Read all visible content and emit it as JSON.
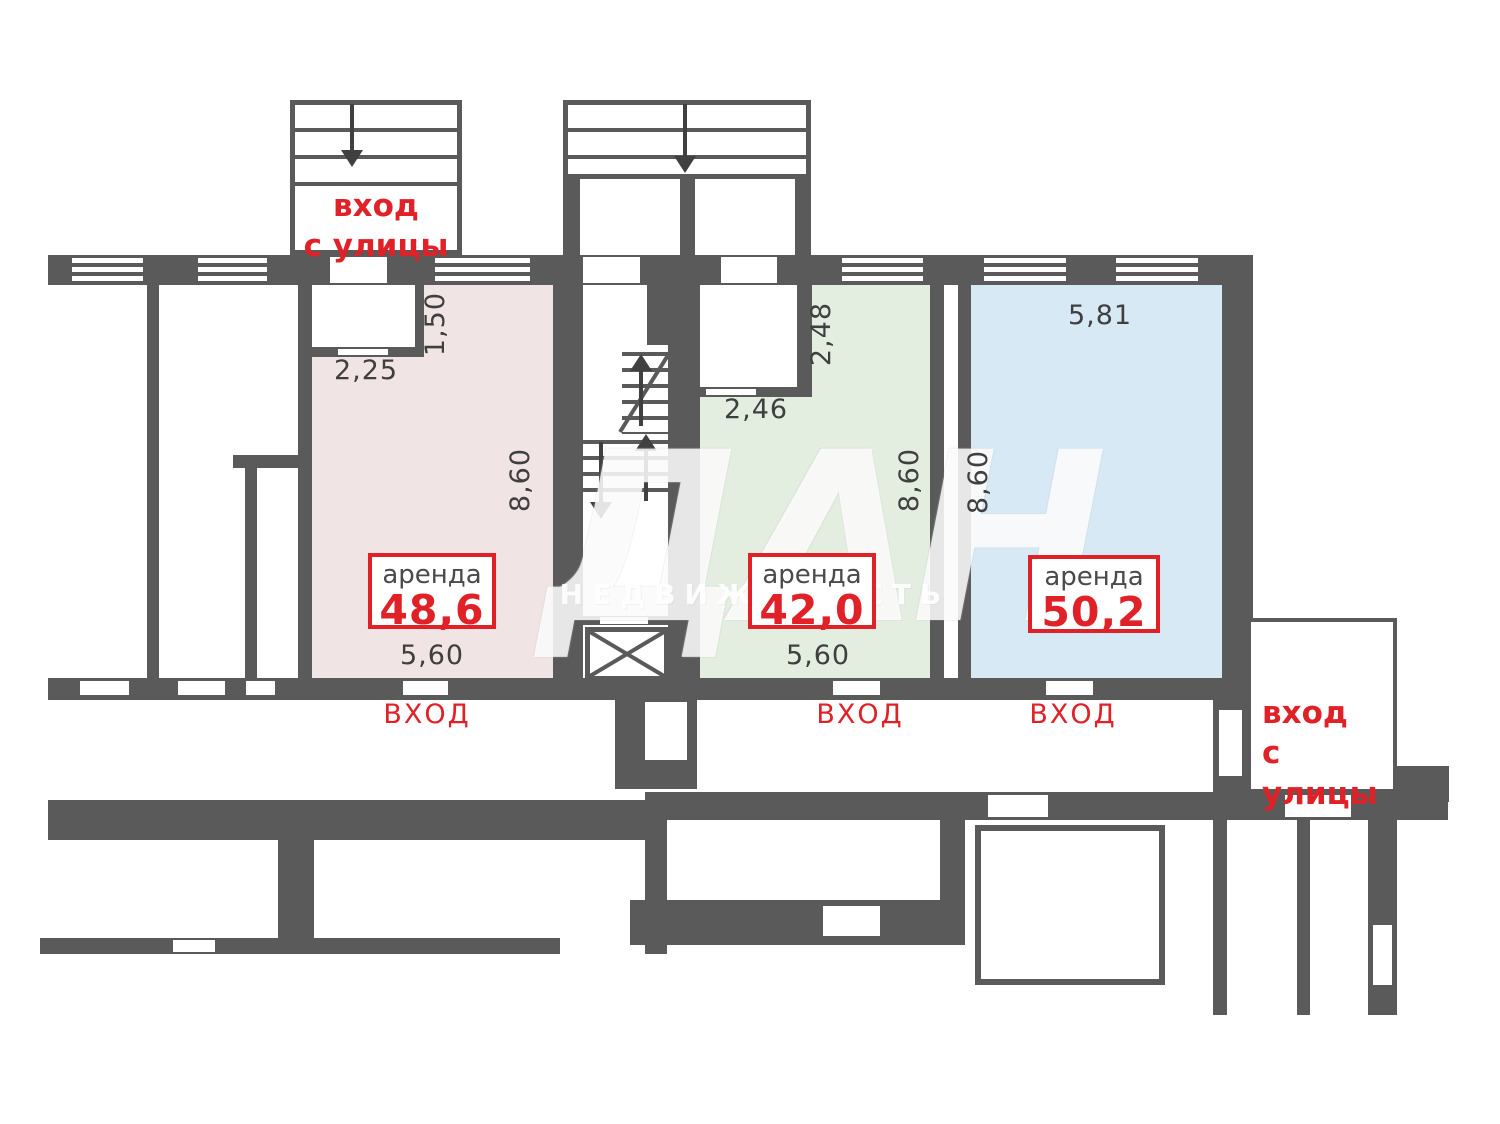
{
  "colors": {
    "wall": "#5a5a5a",
    "accent_red": "#e02128",
    "unit_pink": "#f1e4e4",
    "unit_green": "#e3eee1",
    "unit_blue": "#d8e9f6",
    "dim_text": "#3f3f3f"
  },
  "watermark": {
    "logo": "ДАН",
    "subtitle": "НЕДВИЖИМОСТЬ"
  },
  "entrances": {
    "street_top": {
      "line1": "вход",
      "line2": "с улицы"
    },
    "street_right": {
      "line1": "вход",
      "line2": "с улицы"
    }
  },
  "units": [
    {
      "label": "аренда",
      "area": "48,6",
      "entry": "ВХОД",
      "dims": {
        "notch_width": "2,25",
        "notch_depth": "1,50",
        "depth": "8,60",
        "width": "5,60"
      }
    },
    {
      "label": "аренда",
      "area": "42,0",
      "entry": "ВХОД",
      "dims": {
        "niche_width": "2,46",
        "niche_depth": "2,48",
        "depth": "8,60",
        "width": "5,60"
      }
    },
    {
      "label": "аренда",
      "area": "50,2",
      "entry": "ВХОД",
      "dims": {
        "width": "5,81",
        "depth": "8,60"
      }
    }
  ]
}
